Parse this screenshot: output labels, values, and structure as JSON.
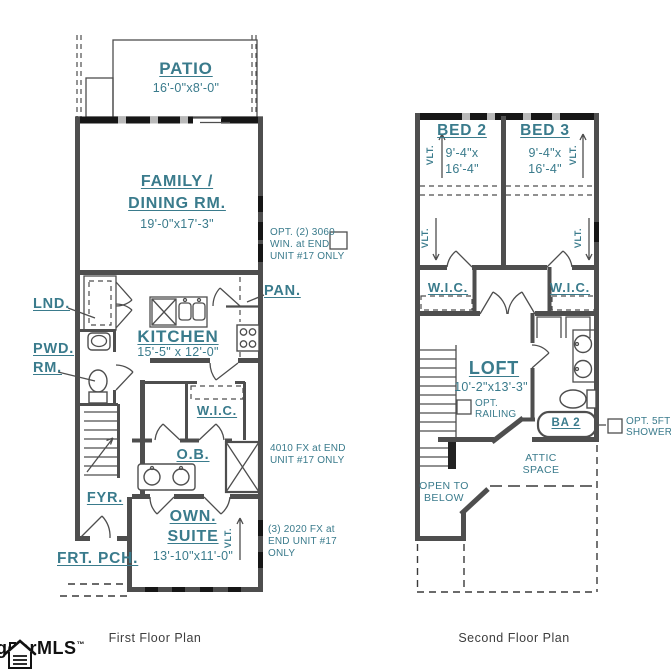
{
  "colors": {
    "accent": "#3A7B8C",
    "wall": "#4E4E4E",
    "ink": "#111111"
  },
  "first_floor": {
    "caption": "First Floor Plan",
    "patio_name": "PATIO",
    "patio_dims": "16'-0\"x8'-0\"",
    "family_name_1": "FAMILY /",
    "family_name_2": "DINING RM.",
    "family_dims": "19'-0\"x17'-3\"",
    "lnd": "LND.",
    "pwd_1": "PWD.",
    "pwd_2": "RM.",
    "kitchen_name": "KITCHEN",
    "kitchen_dims": "15'-5\" x 12'-0\"",
    "pan": "PAN.",
    "wic": "W.I.C.",
    "ob": "O.B.",
    "fyr": "FYR.",
    "own_name_1": "OWN.",
    "own_name_2": "SUITE",
    "own_dims": "13'-10\"x11'-0\"",
    "frt_pch": "FRT. PCH.",
    "vlt": "VLT.",
    "note_opt_win_1": "OPT. (2) 3060",
    "note_opt_win_2": "WIN. at END",
    "note_opt_win_3": "UNIT #17 ONLY",
    "note_fx_1": "4010 FX at END",
    "note_fx_2": "UNIT #17 ONLY",
    "note_2020_1": "(3) 2020 FX at",
    "note_2020_2": "END UNIT #17",
    "note_2020_3": "ONLY"
  },
  "second_floor": {
    "caption": "Second Floor Plan",
    "bed2_name": "BED 2",
    "bed2_dims_1": "9'-4\"x",
    "bed2_dims_2": "16'-4\"",
    "bed3_name": "BED 3",
    "bed3_dims_1": "9'-4\"x",
    "bed3_dims_2": "16'-4\"",
    "wic": "W.I.C.",
    "vlt": "VLT.",
    "loft_name": "LOFT",
    "loft_dims": "10'-2\"x13'-3\"",
    "opt_railing_1": "OPT.",
    "opt_railing_2": "RAILING",
    "ba2": "BA 2",
    "opt_shower_1": "OPT. 5FT",
    "opt_shower_2": "SHOWER",
    "attic_1": "ATTIC",
    "attic_2": "SPACE",
    "open_below_1": "OPEN TO",
    "open_below_2": "BELOW"
  },
  "footer": {
    "logo_text": "ggarMLS",
    "logo_tm": "™"
  }
}
